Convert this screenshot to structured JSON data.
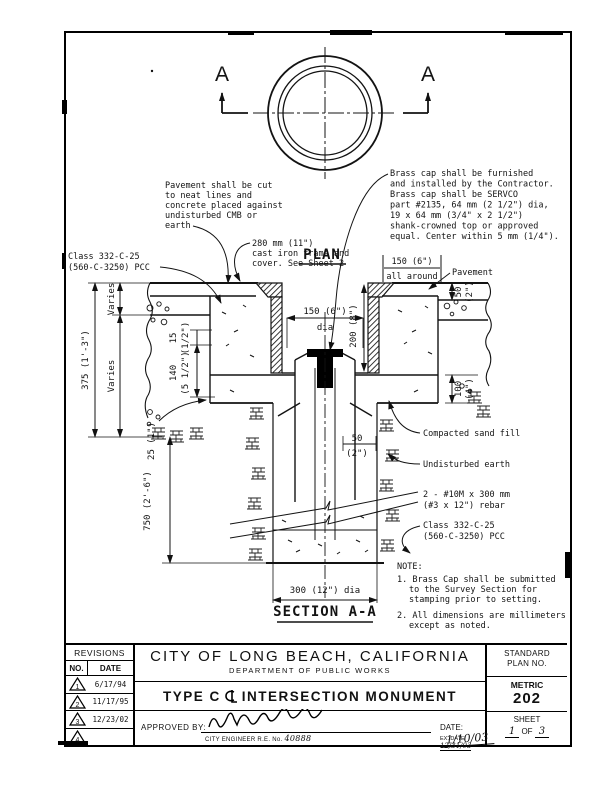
{
  "drawing": {
    "plan_label": "PLAN",
    "marker_letter": "A",
    "section_label": "SECTION A-A"
  },
  "callouts": {
    "pavement_cut": [
      "Pavement shall be cut",
      "to neat lines and",
      "concrete placed against",
      "undisturbed CMB or",
      "earth"
    ],
    "frame_cover": [
      "280 mm (11\")",
      "cast iron frame and",
      "cover. See Sheet 2"
    ],
    "brass_cap": [
      "Brass cap shall be furnished",
      "and installed by the Contractor.",
      "Brass cap shall be SERVCO",
      "part #2135, 64 mm (2 1/2\") dia,",
      "19 x 64 mm (3/4\" x 2 1/2\")",
      "shank-crowned top or approved",
      "equal. Center within 5 mm (1/4\")."
    ],
    "class_pcc": [
      "Class 332-C-25",
      "(560-C-3250) PCC"
    ],
    "pavement": "Pavement",
    "compacted_sand": "Compacted sand fill",
    "undisturbed_earth": "Undisturbed earth",
    "rebar": [
      "2 - #10M x 300 mm",
      "(#3 x 12\") rebar"
    ]
  },
  "dims": {
    "all1": "150 (6\")",
    "all2": "all around",
    "d375": "375 (1'-3\")",
    "varies": "Varies",
    "d15": "15",
    "d15i": "(1/2\")",
    "d140": "140",
    "d140i": "(5 1/2\")",
    "d150": "150 (6\")",
    "dia": "dia",
    "d200": "200 (8\")",
    "d50": "50",
    "d50i": "(2\")",
    "d100": "100",
    "d100i": "(4\")",
    "d25": "25 (1\")",
    "d750": "750 (2'-6\")",
    "d50s": "50",
    "d50si": "(2\")",
    "d300": "300 (12\") dia"
  },
  "notes": {
    "heading": "NOTE:",
    "n1a": "1. Brass Cap shall be submitted",
    "n1b": "to the Survey Section for",
    "n1c": "stamping prior to setting.",
    "n2a": "2. All dimensions are millimeters",
    "n2b": "except as noted."
  },
  "titleblock": {
    "revisions_label": "REVISIONS",
    "col_no": "NO.",
    "col_date": "DATE",
    "rows": [
      {
        "no": "1",
        "date": "6/17/94"
      },
      {
        "no": "2",
        "date": "11/17/95"
      },
      {
        "no": "3",
        "date": "12/23/02"
      },
      {
        "no": "4",
        "date": ""
      }
    ],
    "city": "CITY OF LONG BEACH, CALIFORNIA",
    "department": "DEPARTMENT OF PUBLIC WORKS",
    "title_prefix": "TYPE C",
    "title_suffix": "INTERSECTION MONUMENT",
    "approved_label": "APPROVED BY:",
    "engineer_line": "CITY ENGINEER R.E. No.",
    "engineer_no": "40888",
    "date_label": "DATE:",
    "date_value": "1/10/03",
    "ex_date_label": "EX. DATE",
    "ex_date_value": "12/31/03",
    "standard1": "STANDARD",
    "standard2": "PLAN NO.",
    "metric": "METRIC",
    "plan_no": "202",
    "sheet_label": "SHEET",
    "sheet_n": "1",
    "sheet_of": "OF",
    "sheet_total": "3"
  }
}
